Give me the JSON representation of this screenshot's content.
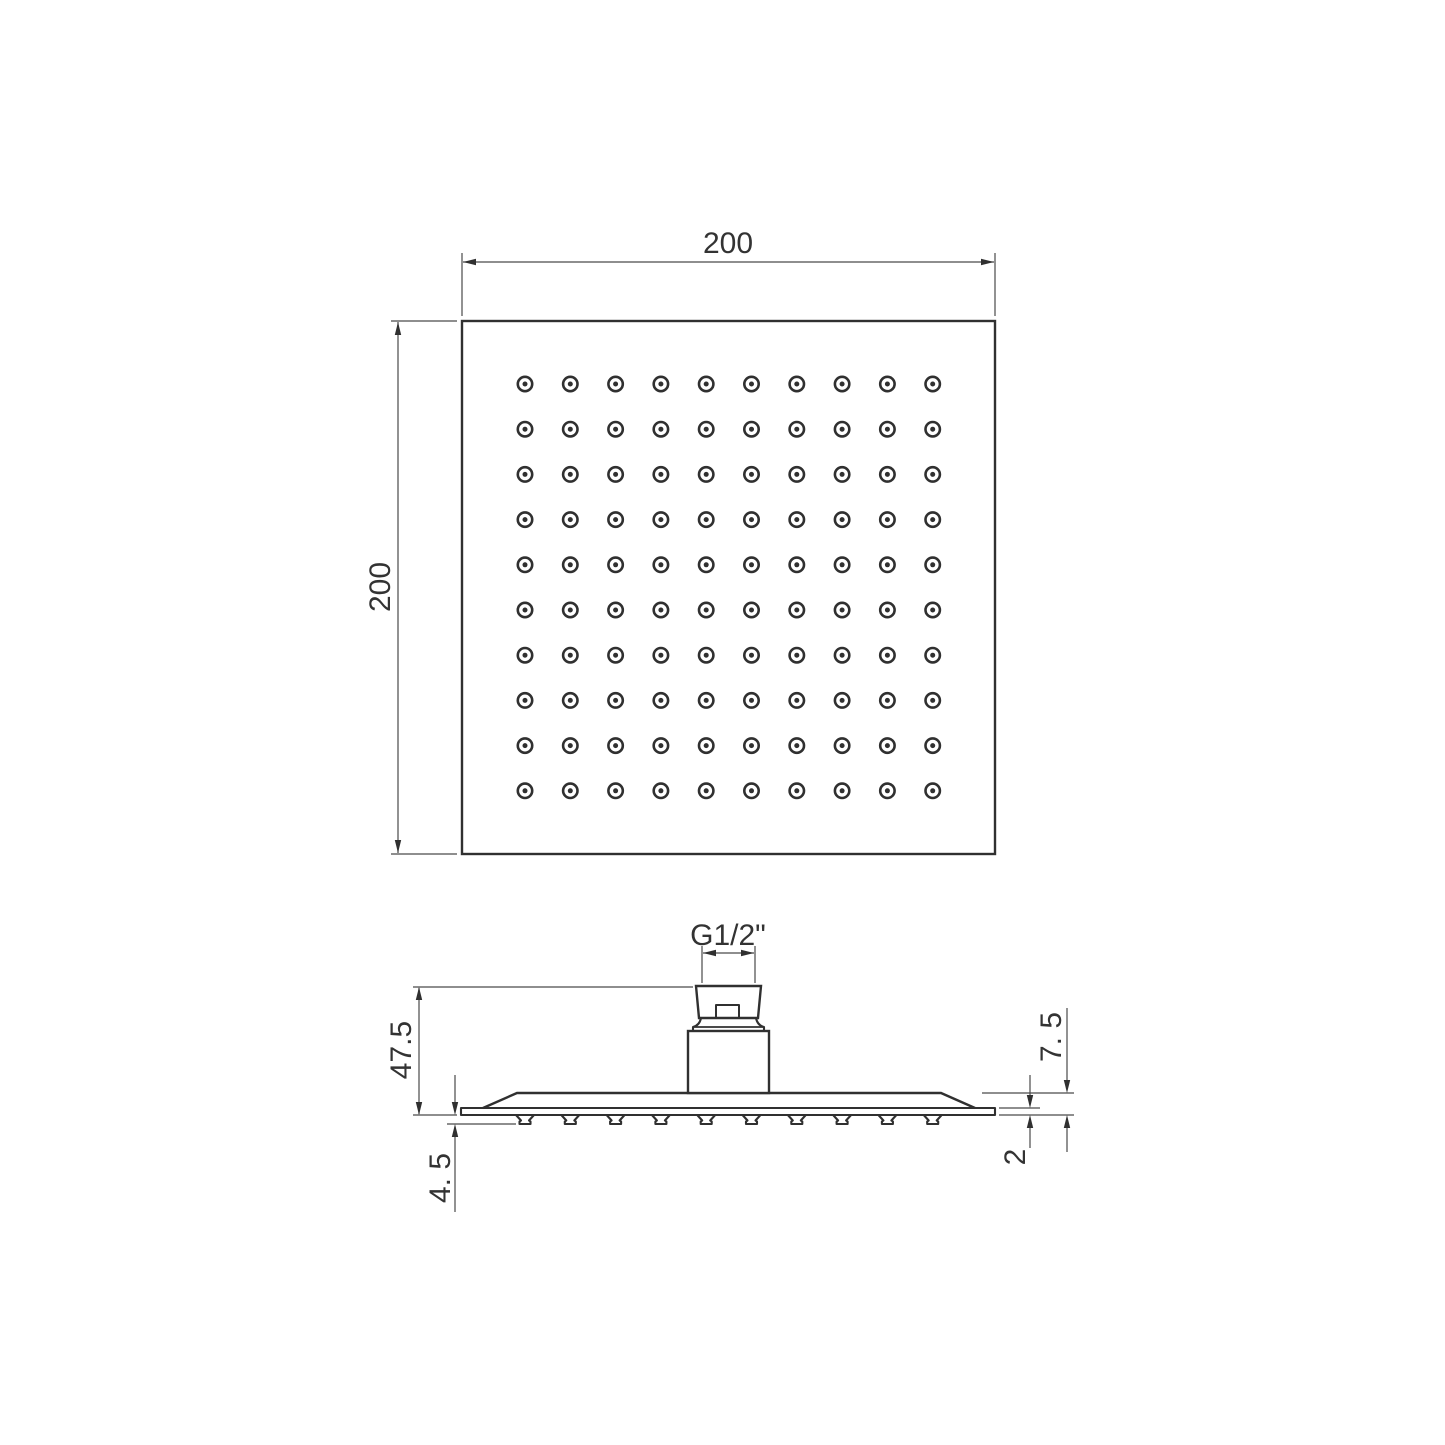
{
  "top_view": {
    "width_label": "200",
    "height_label": "200",
    "grid": {
      "rows": 10,
      "cols": 10
    }
  },
  "side_view": {
    "thread_label": "G1/2\"",
    "total_height_label": "47.5",
    "nozzle_height_label": "4. 5",
    "edge_height_label": "7. 5",
    "plate_thickness_label": "2",
    "nozzle_count": 10
  },
  "colors": {
    "object_line": "#303030",
    "dimension_line": "#4a4a4a",
    "text": "#333333",
    "background": "#ffffff"
  }
}
